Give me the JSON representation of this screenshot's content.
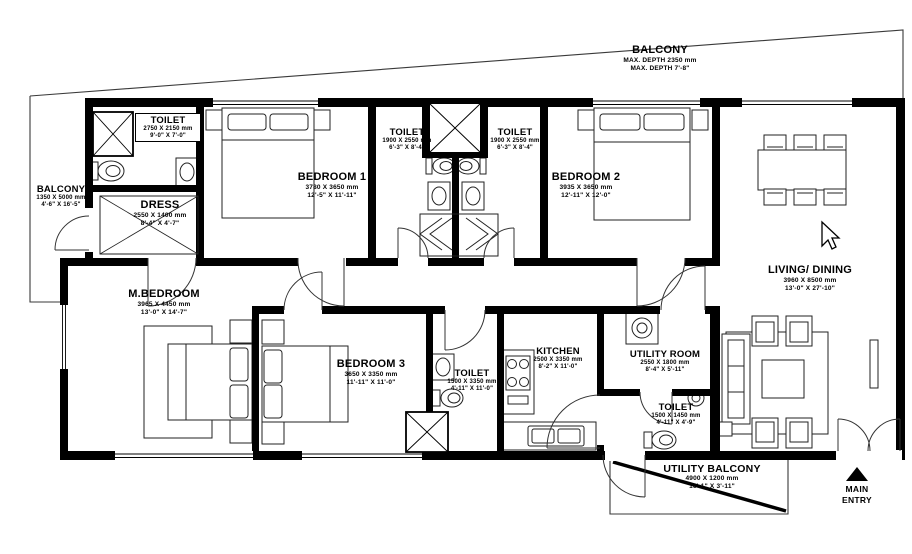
{
  "plan": {
    "title_context": "apartment floor plan",
    "accent_color": "#000000",
    "background_color": "#ffffff",
    "rooms": [
      {
        "id": "balcony-top",
        "name": "BALCONY",
        "size_mm": "MAX. DEPTH 2350 mm",
        "size_ft": "MAX. DEPTH 7'-8\""
      },
      {
        "id": "toilet-top-left",
        "name": "TOILET",
        "size_mm": "2750 X 2150 mm",
        "size_ft": "9'-0\" X 7'-0\""
      },
      {
        "id": "balcony-left",
        "name": "BALCONY",
        "size_mm": "1350 X 5000 mm",
        "size_ft": "4'-6\" X 16'-5\""
      },
      {
        "id": "dress",
        "name": "DRESS",
        "size_mm": "2550 X 1400 mm",
        "size_ft": "8'-4\" X 4'-7\""
      },
      {
        "id": "bedroom-1",
        "name": "BEDROOM 1",
        "size_mm": "3780 X 3650 mm",
        "size_ft": "12'-5\" X 11'-11\""
      },
      {
        "id": "toilet-mid-left",
        "name": "TOILET",
        "size_mm": "1900 X 2550 mm",
        "size_ft": "6'-3\" X 8'-4\""
      },
      {
        "id": "toilet-mid-right",
        "name": "TOILET",
        "size_mm": "1900 X 2550 mm",
        "size_ft": "6'-3\" X 8'-4\""
      },
      {
        "id": "bedroom-2",
        "name": "BEDROOM 2",
        "size_mm": "3935 X 3650 mm",
        "size_ft": "12'-11\" X 12'-0\""
      },
      {
        "id": "living-dining",
        "name": "LIVING/ DINING",
        "size_mm": "3960 X 8500 mm",
        "size_ft": "13'-0\" X 27'-10\""
      },
      {
        "id": "m-bedroom",
        "name": "M.BEDROOM",
        "size_mm": "3965 X 4450 mm",
        "size_ft": "13'-0\" X 14'-7\""
      },
      {
        "id": "bedroom-3",
        "name": "BEDROOM 3",
        "size_mm": "3650 X 3350 mm",
        "size_ft": "11'-11\" X 11'-0\""
      },
      {
        "id": "toilet-bedroom3",
        "name": "TOILET",
        "size_mm": "1500 X 3350 mm",
        "size_ft": "4'-11\" X 11'-0\""
      },
      {
        "id": "kitchen",
        "name": "KITCHEN",
        "size_mm": "2500 X 3350 mm",
        "size_ft": "8'-2\" X 11'-0\""
      },
      {
        "id": "utility-room",
        "name": "UTILITY ROOM",
        "size_mm": "2550 X 1800 mm",
        "size_ft": "8'-4\" X 5'-11\""
      },
      {
        "id": "toilet-utility",
        "name": "TOILET",
        "size_mm": "1500 X 1450 mm",
        "size_ft": "4'-11\" X 4'-9\""
      },
      {
        "id": "utility-balcony",
        "name": "UTILITY BALCONY",
        "size_mm": "4900 X 1200 mm",
        "size_ft": "16'-1\" X 3'-11\""
      }
    ],
    "entry": {
      "line1": "MAIN",
      "line2": "ENTRY"
    },
    "icons": {
      "cursor": "mouse-cursor",
      "entry_arrow": "up-triangle"
    }
  }
}
